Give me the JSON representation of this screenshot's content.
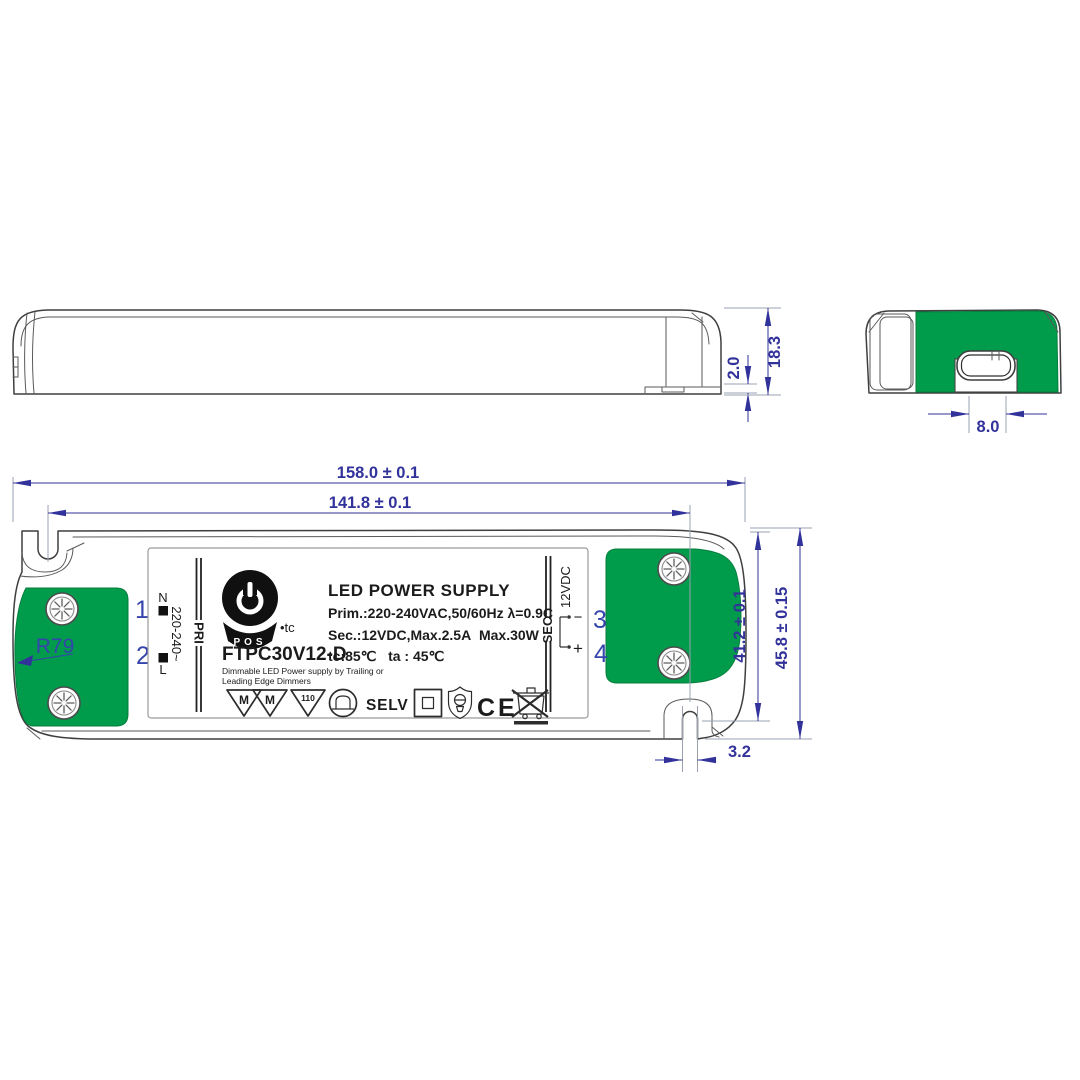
{
  "drawing": {
    "side_view": {
      "dim_foot_height": "2.0",
      "dim_total_height": "18.3"
    },
    "end_view": {
      "dim_connector_width": "8.0"
    },
    "plan_view": {
      "dim_length": "158.0 ± 0.1",
      "dim_mounting_pitch": "141.8 ± 0.1",
      "dim_body_width": "41.2 ± 0.1",
      "dim_overall_width": "45.8 ± 0.15",
      "dim_slot_width": "3.2",
      "radius_label": "R79",
      "terminal_1": "1",
      "terminal_2": "2",
      "terminal_3": "3",
      "terminal_4": "4",
      "neutral_label": "N",
      "live_label": "L",
      "primary_range": "220-240~",
      "pri_label": "PRI",
      "sec_label": "SEC",
      "sec_voltage": "12VDC",
      "minus_label": "−",
      "plus_label": "+"
    },
    "label": {
      "title": "LED POWER SUPPLY",
      "primary_spec": "Prim.:220-240VAC,50/60Hz λ=0.9C",
      "secondary_spec": "Sec.:12VDC,Max.2.5A  Max.30W",
      "model": "FTPC30V12-D",
      "temp_spec": "tc:85℃   ta : 45℃",
      "note_line1": "Dimmable LED Power supply by Trailing or",
      "note_line2": "Leading Edge Dimmers",
      "brand": "POS",
      "brand_suffix": "•tc",
      "selv_mark": "SELV",
      "ce_mark": "CE",
      "triangle_m1": "M",
      "triangle_m2": "M",
      "triangle_110": "110"
    },
    "colors": {
      "pad_green": "#019b4c",
      "dimension_blue": "#32329b",
      "terminal_blue": "#3545ac"
    }
  }
}
